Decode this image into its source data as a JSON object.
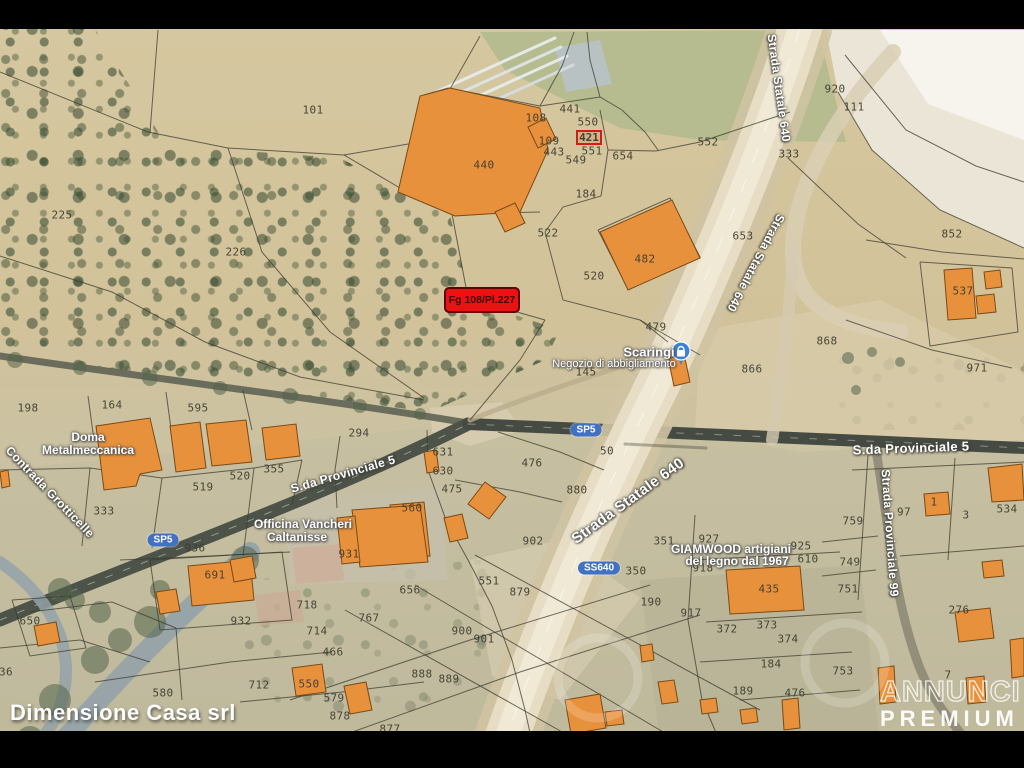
{
  "frame": {
    "width": 1024,
    "height": 768,
    "top_bar_height": 29,
    "bottom_bar_top": 731
  },
  "branding": {
    "agency": "Dimensione Casa srl",
    "watermark_line1": "ANNUNCI",
    "watermark_line2": "PREMIUM"
  },
  "highlight": {
    "text": "Fg 108/Pl.227",
    "x": 444,
    "y": 287,
    "w": 76,
    "h": 26
  },
  "secondary_highlight": {
    "text": "421",
    "x": 576,
    "y": 130,
    "w": 26,
    "h": 15
  },
  "map": {
    "palette": {
      "building": "#e8913c",
      "building_stroke": "#7a4a15",
      "boundary": "#3c3c30",
      "vegetation": "#54654a",
      "badge_blue": "#4271c4",
      "highlight_red": "#ec1212"
    },
    "areas": [
      {
        "pts": "480,32 818,30 846,142 700,140 620,128 505,70",
        "fill": "#b3ba8e",
        "op": 0.9
      },
      {
        "pts": "826,30 1024,30 1024,248 940,210 872,150 838,92",
        "fill": "#ece7da",
        "op": 0.95
      },
      {
        "pts": "880,30 1024,30 1024,140 928,104",
        "fill": "#f7f5ee",
        "op": 0.9
      },
      {
        "pts": "700,330 880,300 1024,372 1024,440 800,452 695,432",
        "fill": "#d8cbaa",
        "op": 0.75
      },
      {
        "pts": "285,498 440,488 448,580 290,585",
        "fill": "#c9c2b2",
        "op": 0.8
      },
      {
        "pts": "292,548 340,544 344,580 296,584",
        "fill": "#d5ab99",
        "op": 0.75
      },
      {
        "pts": "255,595 300,590 304,622 259,626",
        "fill": "#d0a693",
        "op": 0.7
      },
      {
        "pts": "640,580 860,565 880,742 660,742",
        "fill": "#b0ac8e",
        "op": 0.5
      },
      {
        "pts": "0,470 468,424 1024,448 1024,731 0,731",
        "fill": "#b9b69c",
        "op": 0.28
      },
      {
        "pts": "430,408 502,402 522,430 470,446 432,432",
        "fill": "#d8cdb0",
        "op": 0.85
      },
      {
        "pts": "555,48 600,40 612,84 566,92",
        "fill": "#b9c2c8",
        "op": 0.9
      },
      {
        "pts": "470,560 560,540 640,598 560,700 492,676",
        "fill": "#d9cfb4",
        "op": 0.6
      }
    ],
    "roads": [
      {
        "d": "M0,356 C150,378 330,400 468,423",
        "c": "#5f6354",
        "w": 7,
        "op": 0.9
      },
      {
        "d": "M0,620 C140,562 320,498 468,424",
        "c": "#4d5348",
        "w": 13,
        "op": 1
      },
      {
        "d": "M468,424 C650,432 850,440 1024,448",
        "c": "#454b42",
        "w": 12,
        "op": 1
      },
      {
        "d": "M0,620 C140,562 320,498 468,424",
        "c": "#cfd3c6",
        "w": 1,
        "op": 0.55,
        "dash": "7,12"
      },
      {
        "d": "M468,424 C650,432 850,440 1024,448",
        "c": "#cfd3c6",
        "w": 1,
        "op": 0.5,
        "dash": "7,12"
      },
      {
        "d": "M470,420 C520,400 600,372 668,352",
        "c": "#b9ac8c",
        "w": 5,
        "op": 0.8
      },
      {
        "d": "M250,552 C185,612 120,672 40,768",
        "c": "#93a2a8",
        "w": 20,
        "op": 0.9
      },
      {
        "d": "M0,562 C55,600 80,655 58,712 C48,738 25,755 0,762",
        "c": "#93a2a8",
        "w": 12,
        "op": 0.85
      },
      {
        "d": "M876,450 C888,520 893,590 915,655 C928,695 948,718 968,742",
        "c": "#8d8a76",
        "w": 9,
        "op": 0.9
      },
      {
        "d": "M800,28 C765,140 715,260 660,380 C615,470 555,600 505,742",
        "c": "#cfc3a2",
        "w": 64,
        "op": 0.9
      },
      {
        "d": "M800,28 C765,140 715,260 660,380 C615,470 555,600 505,742",
        "c": "#e6ddc4",
        "w": 44,
        "op": 1
      },
      {
        "d": "M800,28 C765,140 715,260 660,380 C615,470 555,600 505,742",
        "c": "#f0e9d6",
        "w": 24,
        "op": 1
      },
      {
        "d": "M800,28 C765,140 715,260 660,380 C615,470 555,600 505,742",
        "c": "#ffffff",
        "w": 1.2,
        "op": 0.5,
        "dash": "14,18"
      },
      {
        "d": "M893,52 C830,120 795,190 793,248 C792,300 830,325 900,332",
        "c": "#d9cfb4",
        "w": 16,
        "op": 0.85
      },
      {
        "d": "M793,248 C790,320 780,390 772,440",
        "c": "#d6cbb0",
        "w": 12,
        "op": 0.8
      },
      {
        "d": "M625,444 L706,448",
        "c": "#3a3a30",
        "w": 3,
        "op": 0.35
      },
      {
        "d": "M436,92 L555,38",
        "c": "#e9eef0",
        "w": 3,
        "op": 0.9
      },
      {
        "d": "M442,101 L561,47",
        "c": "#dfe6e9",
        "w": 3,
        "op": 0.9
      },
      {
        "d": "M448,110 L567,56",
        "c": "#e9eef0",
        "w": 3,
        "op": 0.9
      },
      {
        "d": "M454,119 L573,65",
        "c": "#d6dde1",
        "w": 3,
        "op": 0.9
      }
    ],
    "green_blobs": [
      [
        245,
        560,
        14
      ],
      [
        205,
        585,
        12
      ],
      [
        150,
        622,
        16
      ],
      [
        95,
        660,
        14
      ],
      [
        55,
        700,
        16
      ],
      [
        30,
        740,
        14
      ],
      [
        160,
        590,
        10
      ],
      [
        120,
        640,
        12
      ],
      [
        75,
        600,
        10
      ],
      [
        60,
        590,
        12
      ],
      [
        100,
        612,
        11
      ],
      [
        15,
        360,
        8
      ],
      [
        80,
        368,
        7
      ],
      [
        150,
        378,
        8
      ],
      [
        220,
        388,
        7
      ],
      [
        290,
        396,
        8
      ],
      [
        360,
        406,
        7
      ],
      [
        420,
        414,
        6
      ],
      [
        848,
        358,
        6
      ],
      [
        872,
        352,
        5
      ],
      [
        900,
        362,
        5
      ],
      [
        856,
        390,
        5
      ]
    ],
    "boundaries": [
      "0,72 148,132 228,148 344,155 400,188",
      "150,132 158,30",
      "344,155 420,142 480,36",
      "228,148 262,252 330,332 424,398",
      "0,256 112,292 205,342 300,377 424,400",
      "424,95 448,88 540,106",
      "540,106 562,66 574,32",
      "540,106 600,97 622,110 645,132 658,150",
      "600,97 590,60 587,32",
      "600,110 608,150 601,196 563,207 545,232",
      "608,150 656,151",
      "656,151 700,142 742,128 790,112",
      "545,232 563,300 640,320 668,342",
      "598,230 670,198 700,257 628,289 598,230",
      "845,55 906,130 976,166 1024,182",
      "788,158 858,224 906,258",
      "866,240 942,252 1024,259",
      "920,262 1012,268 1018,332 930,346 920,262",
      "846,320 932,350 1012,368",
      "838,92 872,150 940,210 1024,248",
      "400,188 452,214 468,298 545,320",
      "452,214 540,212",
      "88,396 94,440",
      "166,392 172,436",
      "243,390 252,430",
      "0,470 90,468 162,478 254,468 302,460",
      "90,468 82,546",
      "162,478 152,548",
      "254,468 243,556",
      "302,460 292,505",
      "337,508 335,470 340,436",
      "427,430 428,470 446,520 468,560 492,606 512,660 525,710 532,742",
      "498,432 560,452 604,470",
      "455,480 520,492 562,502",
      "545,320 520,360 470,420",
      "640,320 700,355",
      "345,610 580,742",
      "415,585 680,742",
      "475,555 760,710",
      "290,700 470,640 650,585",
      "330,740 520,672 700,615",
      "868,455 858,600",
      "822,542 878,536",
      "822,576 876,570",
      "955,458 948,560",
      "900,556 1024,546",
      "852,470 1024,462",
      "695,515 688,620 702,700 720,742",
      "695,560 840,552",
      "706,622 862,612",
      "700,662 852,652",
      "740,700 860,690",
      "30,612 112,602 176,628",
      "0,648 80,640 150,662",
      "95,682 230,662 332,652",
      "240,702 342,692 424,682",
      "120,560 210,556 290,552",
      "12,600 70,596 86,648 30,656 12,600",
      "150,560 282,552 292,620 160,630 150,560",
      "176,628 182,700"
    ],
    "buildings": [
      {
        "pts": "398,192 420,96 450,88 540,108 548,150 520,212 455,216"
      },
      {
        "pts": "495,212 515,203 525,223 505,232"
      },
      {
        "pts": "528,127 546,118 556,139 538,148"
      },
      {
        "pts": "600,232 672,200 700,258 628,290"
      },
      {
        "pts": "668,358 684,354 690,382 674,386"
      },
      {
        "pts": "96,426 150,418 162,470 140,474 136,486 104,490"
      },
      {
        "pts": "170,426 200,422 206,468 176,472"
      },
      {
        "pts": "206,424 246,420 252,462 212,466"
      },
      {
        "pts": "262,428 296,424 300,456 266,460"
      },
      {
        "pts": "390,505 424,502 430,556 396,559"
      },
      {
        "pts": "352,510 420,505 428,562 360,567"
      },
      {
        "pts": "337,518 355,516 360,562 342,564"
      },
      {
        "pts": "485,482 506,497 489,519 468,504"
      },
      {
        "pts": "444,518 462,514 468,538 450,542"
      },
      {
        "pts": "424,452 436,450 439,471 427,473"
      },
      {
        "pts": "188,566 250,560 254,600 192,606"
      },
      {
        "pts": "156,592 176,589 180,611 160,614"
      },
      {
        "pts": "34,626 56,622 60,642 38,646"
      },
      {
        "pts": "292,668 322,664 326,692 296,696"
      },
      {
        "pts": "344,686 366,682 372,710 350,714"
      },
      {
        "pts": "726,570 800,566 804,610 730,614"
      },
      {
        "pts": "944,270 972,268 976,318 948,320"
      },
      {
        "pts": "984,272 1000,270 1002,287 986,289"
      },
      {
        "pts": "976,296 994,294 996,312 978,314"
      },
      {
        "pts": "988,468 1022,464 1024,500 992,502"
      },
      {
        "pts": "924,494 948,492 950,514 926,516"
      },
      {
        "pts": "982,562 1002,560 1004,576 984,578"
      },
      {
        "pts": "955,612 990,608 994,638 959,642"
      },
      {
        "pts": "878,668 894,666 896,702 880,704"
      },
      {
        "pts": "966,678 984,676 986,702 968,704"
      },
      {
        "pts": "1010,640 1024,638 1024,676 1012,678"
      },
      {
        "pts": "640,646 652,644 654,660 642,662"
      },
      {
        "pts": "658,682 674,680 678,702 662,704"
      },
      {
        "pts": "700,700 716,698 718,712 702,714"
      },
      {
        "pts": "740,710 756,708 758,722 742,724"
      },
      {
        "pts": "782,700 798,698 800,728 784,730"
      },
      {
        "pts": "230,560 252,556 256,578 234,582"
      },
      {
        "pts": "565,700 600,694 606,728 571,734"
      },
      {
        "pts": "0,472 8,470 10,486 2,488"
      },
      {
        "pts": "605,712 622,710 624,724 607,726"
      }
    ],
    "parcels": [
      {
        "n": "101",
        "x": 313,
        "y": 110
      },
      {
        "n": "225",
        "x": 62,
        "y": 215
      },
      {
        "n": "226",
        "x": 236,
        "y": 252
      },
      {
        "n": "440",
        "x": 484,
        "y": 165
      },
      {
        "n": "108",
        "x": 536,
        "y": 118
      },
      {
        "n": "441",
        "x": 570,
        "y": 109
      },
      {
        "n": "550",
        "x": 588,
        "y": 122
      },
      {
        "n": "109",
        "x": 549,
        "y": 141
      },
      {
        "n": "443",
        "x": 554,
        "y": 152
      },
      {
        "n": "551",
        "x": 592,
        "y": 151
      },
      {
        "n": "549",
        "x": 576,
        "y": 160
      },
      {
        "n": "654",
        "x": 623,
        "y": 156
      },
      {
        "n": "184",
        "x": 586,
        "y": 194
      },
      {
        "n": "552",
        "x": 708,
        "y": 142
      },
      {
        "n": "522",
        "x": 548,
        "y": 233
      },
      {
        "n": "482",
        "x": 645,
        "y": 259
      },
      {
        "n": "520",
        "x": 594,
        "y": 276
      },
      {
        "n": "479",
        "x": 656,
        "y": 327
      },
      {
        "n": "653",
        "x": 743,
        "y": 236
      },
      {
        "n": "920",
        "x": 835,
        "y": 89
      },
      {
        "n": "111",
        "x": 854,
        "y": 107
      },
      {
        "n": "333",
        "x": 789,
        "y": 154
      },
      {
        "n": "852",
        "x": 952,
        "y": 234
      },
      {
        "n": "537",
        "x": 963,
        "y": 291
      },
      {
        "n": "971",
        "x": 977,
        "y": 368
      },
      {
        "n": "866",
        "x": 752,
        "y": 369
      },
      {
        "n": "868",
        "x": 827,
        "y": 341
      },
      {
        "n": "145",
        "x": 586,
        "y": 372
      },
      {
        "n": "198",
        "x": 28,
        "y": 408
      },
      {
        "n": "164",
        "x": 112,
        "y": 405
      },
      {
        "n": "595",
        "x": 198,
        "y": 408
      },
      {
        "n": "294",
        "x": 359,
        "y": 433
      },
      {
        "n": "631",
        "x": 443,
        "y": 452
      },
      {
        "n": "630",
        "x": 443,
        "y": 471
      },
      {
        "n": "476",
        "x": 532,
        "y": 463
      },
      {
        "n": "475",
        "x": 452,
        "y": 489
      },
      {
        "n": "560",
        "x": 412,
        "y": 508
      },
      {
        "n": "519",
        "x": 203,
        "y": 487
      },
      {
        "n": "520",
        "x": 240,
        "y": 476
      },
      {
        "n": "355",
        "x": 274,
        "y": 469
      },
      {
        "n": "333",
        "x": 104,
        "y": 511
      },
      {
        "n": "936",
        "x": 195,
        "y": 548
      },
      {
        "n": "50",
        "x": 607,
        "y": 451
      },
      {
        "n": "880",
        "x": 577,
        "y": 490
      },
      {
        "n": "902",
        "x": 533,
        "y": 541
      },
      {
        "n": "351",
        "x": 664,
        "y": 541
      },
      {
        "n": "927",
        "x": 709,
        "y": 539
      },
      {
        "n": "918",
        "x": 703,
        "y": 568
      },
      {
        "n": "350",
        "x": 636,
        "y": 571
      },
      {
        "n": "925",
        "x": 801,
        "y": 546
      },
      {
        "n": "610",
        "x": 808,
        "y": 559
      },
      {
        "n": "759",
        "x": 853,
        "y": 521
      },
      {
        "n": "97",
        "x": 904,
        "y": 512
      },
      {
        "n": "1",
        "x": 934,
        "y": 502
      },
      {
        "n": "3",
        "x": 966,
        "y": 515
      },
      {
        "n": "534",
        "x": 1007,
        "y": 509
      },
      {
        "n": "749",
        "x": 850,
        "y": 562
      },
      {
        "n": "751",
        "x": 848,
        "y": 589
      },
      {
        "n": "435",
        "x": 769,
        "y": 589
      },
      {
        "n": "931",
        "x": 349,
        "y": 554
      },
      {
        "n": "656",
        "x": 410,
        "y": 590
      },
      {
        "n": "551",
        "x": 489,
        "y": 581
      },
      {
        "n": "879",
        "x": 520,
        "y": 592
      },
      {
        "n": "190",
        "x": 651,
        "y": 602
      },
      {
        "n": "917",
        "x": 691,
        "y": 613
      },
      {
        "n": "372",
        "x": 727,
        "y": 629
      },
      {
        "n": "373",
        "x": 767,
        "y": 625
      },
      {
        "n": "374",
        "x": 788,
        "y": 639
      },
      {
        "n": "184",
        "x": 771,
        "y": 664
      },
      {
        "n": "189",
        "x": 743,
        "y": 691
      },
      {
        "n": "753",
        "x": 843,
        "y": 671
      },
      {
        "n": "276",
        "x": 959,
        "y": 610
      },
      {
        "n": "718",
        "x": 307,
        "y": 605
      },
      {
        "n": "767",
        "x": 369,
        "y": 618
      },
      {
        "n": "714",
        "x": 317,
        "y": 631
      },
      {
        "n": "932",
        "x": 241,
        "y": 621
      },
      {
        "n": "466",
        "x": 333,
        "y": 652
      },
      {
        "n": "900",
        "x": 462,
        "y": 631
      },
      {
        "n": "901",
        "x": 484,
        "y": 639
      },
      {
        "n": "888",
        "x": 422,
        "y": 674
      },
      {
        "n": "889",
        "x": 449,
        "y": 679
      },
      {
        "n": "712",
        "x": 259,
        "y": 685
      },
      {
        "n": "550",
        "x": 309,
        "y": 684
      },
      {
        "n": "579",
        "x": 334,
        "y": 698
      },
      {
        "n": "878",
        "x": 340,
        "y": 716
      },
      {
        "n": "877",
        "x": 390,
        "y": 729
      },
      {
        "n": "691",
        "x": 215,
        "y": 575
      },
      {
        "n": "650",
        "x": 30,
        "y": 621
      },
      {
        "n": "580",
        "x": 163,
        "y": 693
      },
      {
        "n": "36",
        "x": 6,
        "y": 672
      },
      {
        "n": "476",
        "x": 795,
        "y": 693
      },
      {
        "n": "7",
        "x": 948,
        "y": 675
      }
    ],
    "road_labels": [
      {
        "text": "S.da Provinciale 5",
        "x": 343,
        "y": 474,
        "rot": -16,
        "size": 12
      },
      {
        "text": "S.da Provinciale 5",
        "x": 911,
        "y": 448,
        "rot": -2,
        "size": 13
      },
      {
        "text": "Strada Statale 640",
        "x": 779,
        "y": 88,
        "rot": 82,
        "size": 12
      },
      {
        "text": "Strada Statale 640",
        "x": 756,
        "y": 263,
        "rot": 118,
        "size": 12
      },
      {
        "text": "Strada Statale 640",
        "x": 628,
        "y": 501,
        "rot": -36,
        "size": 15
      },
      {
        "text": "Strada Provinciale 99",
        "x": 890,
        "y": 533,
        "rot": 86,
        "size": 12
      },
      {
        "text": "Contrada Grotticelle",
        "x": 50,
        "y": 492,
        "rot": 46,
        "size": 12
      }
    ],
    "badges": [
      {
        "text": "SP5",
        "x": 163,
        "y": 540
      },
      {
        "text": "SP5",
        "x": 586,
        "y": 430
      },
      {
        "text": "SS640",
        "x": 599,
        "y": 568
      }
    ],
    "poi_labels": [
      {
        "text": "Scaringi",
        "x": 649,
        "y": 352,
        "size": 13,
        "b": true
      },
      {
        "text": "Negozio di abbigliamento",
        "x": 614,
        "y": 364,
        "size": 11,
        "b": false
      },
      {
        "text": "Doma",
        "x": 88,
        "y": 437,
        "size": 12,
        "b": true
      },
      {
        "text": "Metalmeccanica",
        "x": 88,
        "y": 450,
        "size": 12,
        "b": true
      },
      {
        "text": "Officina Vancheri",
        "x": 303,
        "y": 524,
        "size": 12,
        "b": true
      },
      {
        "text": "Caltanisse",
        "x": 297,
        "y": 537,
        "size": 12,
        "b": true
      },
      {
        "text": "GIAMWOOD artigiani",
        "x": 731,
        "y": 549,
        "size": 12,
        "b": true
      },
      {
        "text": "del legno dal 1967",
        "x": 737,
        "y": 561,
        "size": 12,
        "b": true
      }
    ],
    "pin": {
      "x": 681,
      "y": 351,
      "color": "#3b82d8",
      "icon": "shopping-bag"
    },
    "ghost_rings": [
      [
        845,
        663,
        40
      ],
      [
        598,
        678,
        40
      ]
    ]
  }
}
